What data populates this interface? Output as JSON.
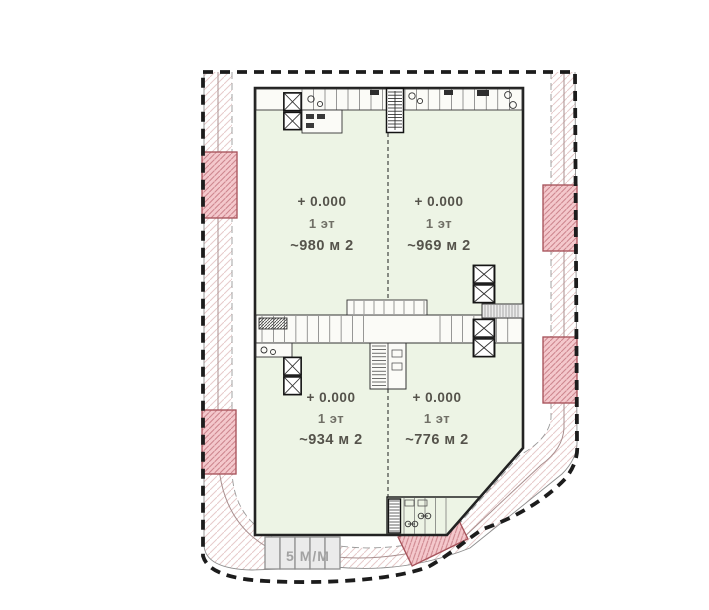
{
  "plan": {
    "units": [
      {
        "elevation": "+ 0.000",
        "floor": "1 эт",
        "area": "~980 м 2"
      },
      {
        "elevation": "+ 0.000",
        "floor": "1 эт",
        "area": "~969 м 2"
      },
      {
        "elevation": "+ 0.000",
        "floor": "1 эт",
        "area": "~934 м 2"
      },
      {
        "elevation": "+ 0.000",
        "floor": "1 эт",
        "area": "~776 м 2"
      }
    ],
    "parking": {
      "label": "5 М/М",
      "stalls": 5
    },
    "colors": {
      "building_fill": "#edf4e5",
      "parking_fill": "#f4c8cc",
      "parking_hatch": "#cd868e",
      "road_hatch": "#e7caca",
      "boundary": "#1c1c1c",
      "label_text": "#55534b",
      "parking_label_text": "#a2a2a2"
    }
  }
}
